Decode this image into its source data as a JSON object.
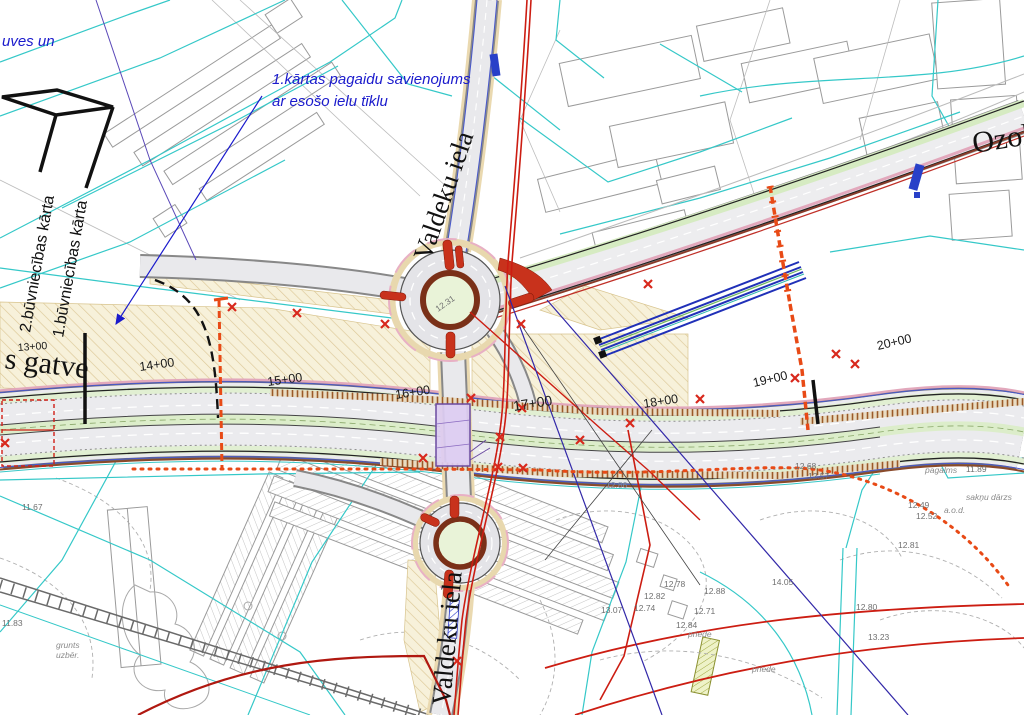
{
  "drawing": {
    "notes": {
      "corner_fragment": "uves un",
      "temp_connection_1": "1.kārtas pagaidu savienojums",
      "temp_connection_2": "ar esošo ielu tīklu",
      "phase_2": "2.būvniecības kārta",
      "phase_1": "1.būvniecības kārta"
    },
    "streets": {
      "valdeku_north": "Valdeku iela",
      "valdeku_south": "Valdeku iela",
      "ozolciema_fragment": "Ozolc",
      "gatve_fragment": "s gatve"
    },
    "stations": [
      "13+00",
      "14+00",
      "15+00",
      "16+00",
      "17+00",
      "18+00",
      "19+00",
      "20+00"
    ],
    "elevations": [
      "11.67",
      "11.83",
      "12.86",
      "12.68",
      "12.57",
      "12.49",
      "12.52",
      "12.81",
      "11.89",
      "12.78",
      "12.88",
      "12.82",
      "12.74",
      "12.71",
      "13.07",
      "12.84",
      "14.05",
      "12.80",
      "13.23",
      "12.31"
    ],
    "terrain_labels": [
      "pagalms",
      "sakņu dārzs",
      "a.o.d.",
      "grunts",
      "uzbēr.",
      "priede",
      "priede"
    ],
    "colors": {
      "parcel_cyan": "#35c8c8",
      "boundary_red": "#cc1d12",
      "construction_orange": "#e84a16",
      "utility_blue": "#2030b8",
      "bridge_purple": "#dcccf2",
      "apron_brown": "#7a3018",
      "island_red": "#c8321c",
      "island_green": "#e9f3d8",
      "construction_tan": "#f7f1da",
      "asphalt": "#ebebee",
      "median_green": "#dcedca",
      "annotation_blue": "#1a1acc"
    }
  }
}
